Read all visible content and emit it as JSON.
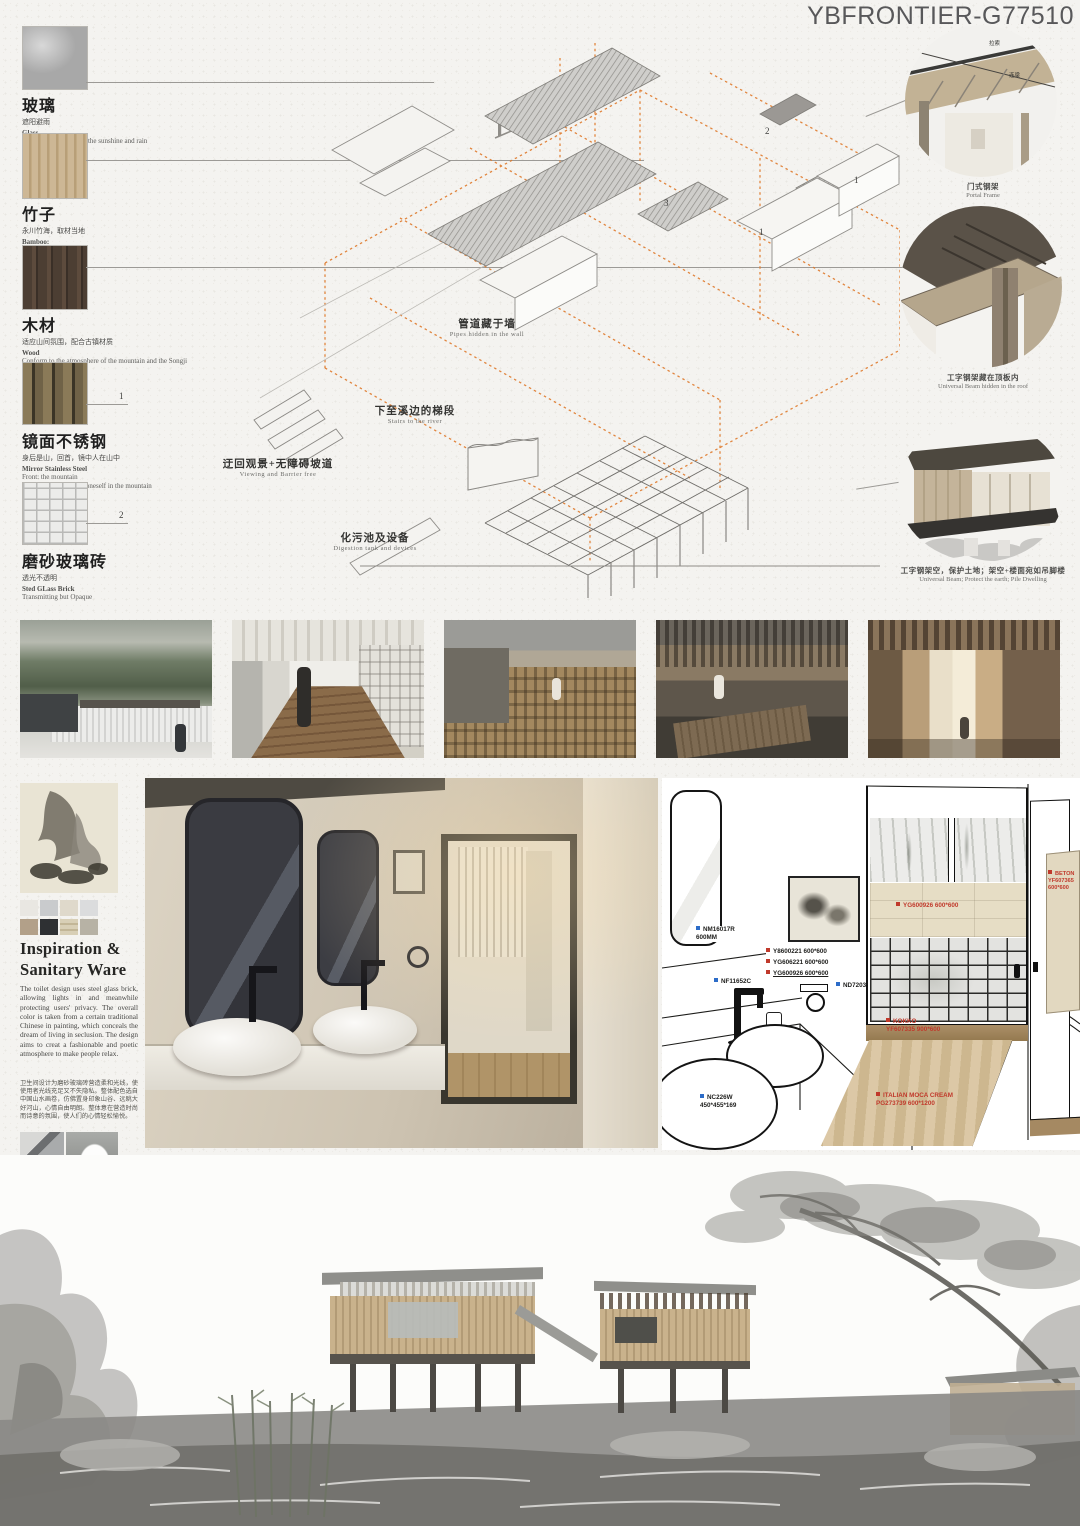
{
  "title": "YBFRONTIER-G77510",
  "colors": {
    "accent_orange": "#df7a2b",
    "marker_blue": "#2c6cc8",
    "marker_red": "#c0392b"
  },
  "materials": [
    {
      "zh": "玻璃",
      "sub": "遮阳避雨",
      "en": "Glass",
      "desc": "To protect people from the sunshine and rain",
      "marker": ""
    },
    {
      "zh": "竹子",
      "sub": "永川竹海，取材当地",
      "en": "Bamboo:",
      "desc": "Yongchuan Bamboo",
      "marker": ""
    },
    {
      "zh": "木材",
      "sub": "适应山间氛围，配合古镇材质",
      "en": "Wood",
      "desc": "Conform to the atmosphere of the mountain and the Songji Town",
      "marker": ""
    },
    {
      "zh": "镜面不锈钢",
      "sub": "身后是山，回首，镜中人在山中",
      "en": "Mirror Stainless Steel",
      "desc": "Front: the mountain\nTurn back around: see oneself in the mountain",
      "marker": "1"
    },
    {
      "zh": "磨砂玻璃砖",
      "sub": "透光不透明",
      "en": "Sted GLass Brick",
      "desc": "Transmitting but Opaque",
      "marker": "2"
    }
  ],
  "axon": {
    "labels": [
      {
        "zh": "管道藏于墙",
        "en": "Pipes hidden in the wall"
      },
      {
        "zh": "下至溪边的梯段",
        "en": "Stairs to the river"
      },
      {
        "zh": "迂回观景+无障碍坡道",
        "en": "Viewing and Barrier free"
      },
      {
        "zh": "化污池及设备",
        "en": "Digestion tank and devices"
      }
    ],
    "markers": [
      "2",
      "3",
      "1",
      "1"
    ]
  },
  "details": [
    {
      "zh": "门式钢架",
      "en": "Portal Frame",
      "ann1": "拉索",
      "ann2": "连梁"
    },
    {
      "zh": "工字钢架藏在顶板内",
      "en": "Universal Beam hidden in the roof"
    },
    {
      "zh": "工字钢架空，保护土地；架空+楼面宛如吊脚楼",
      "en": "Universal Beam; Protect the earth; Pile Dwelling"
    }
  ],
  "inspiration": {
    "heading": "Inspiration &\nSanitary Ware",
    "body_en": "The toilet design uses steel glass brick, allowing lights in and meanwhile protecting users' privacy. The overall color is taken from a certain traditional Chinese in painting, which conceals the dream of living in seclusion. The design aims to creat a fashionable and poetic atmosphere to make people relax.",
    "body_zh": "卫生间设计为磨砂玻璃砖营造柔和光线，使使用者光线充足又不失隐私。整体配色选自中国山水画卷，仿佛置身印象山谷、远眺大好河山，心情自由明朗。整体意在营造时尚而诗意的氛围，使人们的心情轻松愉悦。"
  },
  "bath": {
    "blue1": "NM16017R\n600MM",
    "blue2": "NF11652C",
    "blue3": "ND7203",
    "blue4": "NC226W\n450*455*169",
    "red1": "Y8600221 600*600",
    "red2": "YG606221 600*600",
    "red3": "YG600926 600*600",
    "red4": "BETON\nYF607365\n600*600",
    "red5": "YG600926 600*600",
    "red6": "KOKKO\nYF607335 900*600",
    "red7": "ITALIAN MOCA CREAM\nPG273739  600*1200"
  }
}
